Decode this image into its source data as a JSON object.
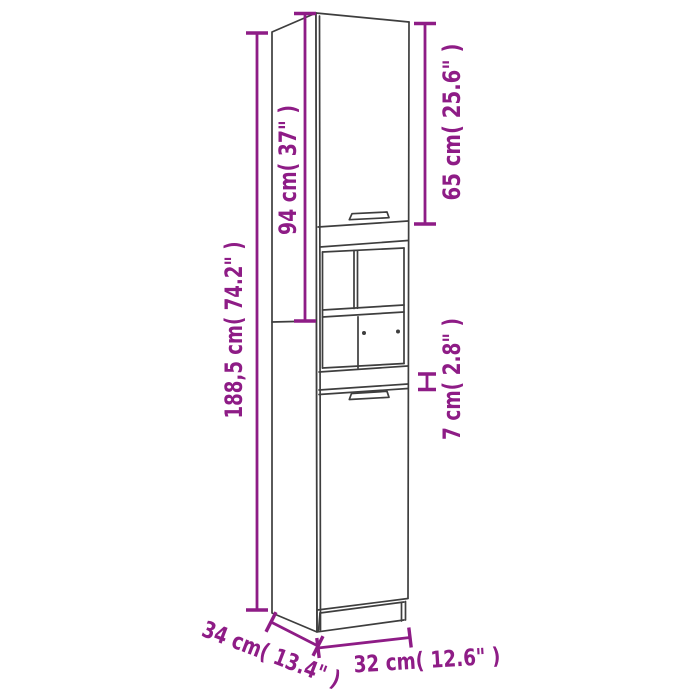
{
  "diagram": {
    "type": "furniture_dimension_line_drawing",
    "subject": "tall-cabinet",
    "colors": {
      "accent": "#8E1C86",
      "outline": "#3E3E3E",
      "background": "#FFFFFF"
    },
    "dimensions": {
      "total_height": {
        "label": "188,5 cm( 74.2\" )",
        "cm": 188.5,
        "inches": 74.2,
        "orientation": "vertical"
      },
      "upper_section": {
        "label": "94 cm( 37\" )",
        "cm": 94,
        "inches": 37,
        "orientation": "vertical"
      },
      "upper_door": {
        "label": "65 cm( 25.6\" )",
        "cm": 65,
        "inches": 25.6,
        "orientation": "vertical"
      },
      "apron_gap": {
        "label": "7 cm( 2.8\" )",
        "cm": 7,
        "inches": 2.8,
        "orientation": "vertical"
      },
      "depth": {
        "label": "34 cm( 13.4\" )",
        "cm": 34,
        "inches": 13.4,
        "orientation": "diagonal"
      },
      "width": {
        "label": "32 cm( 12.6\" )",
        "cm": 32,
        "inches": 12.6,
        "orientation": "horizontal"
      }
    }
  }
}
